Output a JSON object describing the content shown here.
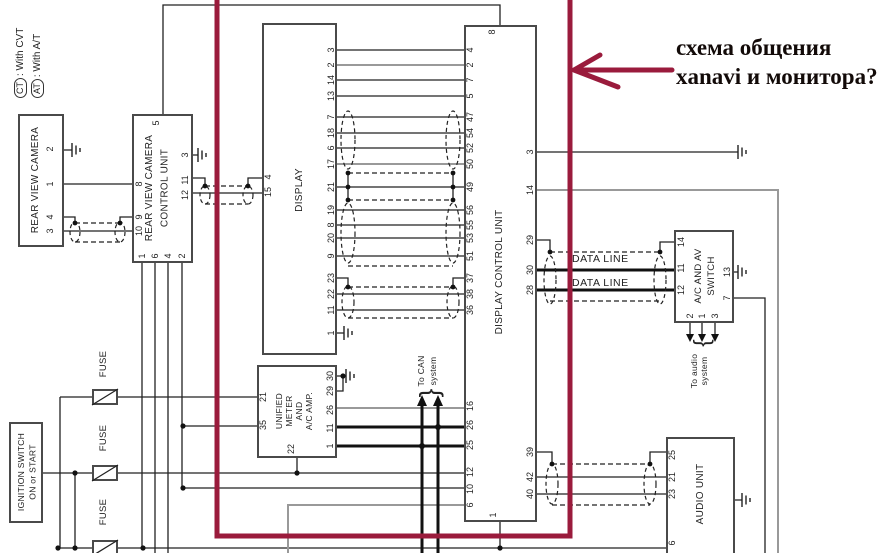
{
  "note": {
    "l1": "схема общения",
    "l2": "xanavi и монитора?"
  },
  "legend": {
    "ct_badge": "CT",
    "ct_text": ": With CVT",
    "at_badge": "AT",
    "at_text": ": With A/T"
  },
  "labels": {
    "data_line": "DATA LINE",
    "can1": "To CAN",
    "can2": "system",
    "aud1": "To audio",
    "aud2": "system",
    "fuse": "FUSE"
  },
  "cam": {
    "title": "REAR VIEW CAMERA",
    "p": [
      "2",
      "1",
      "4",
      "3"
    ]
  },
  "rvccu": {
    "t1": "REAR VIEW CAMERA",
    "t2": "CONTROL UNIT",
    "top": "5",
    "left": [
      "8",
      "9",
      "10"
    ],
    "right": [
      "3",
      "11",
      "12"
    ],
    "bottom": [
      "1",
      "6",
      "4",
      "2"
    ]
  },
  "disp": {
    "title": "DISPLAY",
    "left": [
      "4",
      "15"
    ],
    "right": [
      "3",
      "2",
      "14",
      "13",
      "7",
      "18",
      "6",
      "17",
      "21",
      "19",
      "8",
      "20",
      "9",
      "23",
      "22",
      "11",
      "1"
    ]
  },
  "dcu": {
    "title": "DISPLAY CONTROL UNIT",
    "top": "8",
    "bottom": "1",
    "lu": [
      "4",
      "2",
      "7",
      "5",
      "47",
      "54",
      "52",
      "50",
      "49",
      "56",
      "55",
      "53",
      "51",
      "37",
      "38",
      "36"
    ],
    "ll": [
      "16",
      "26",
      "25",
      "12",
      "10",
      "6"
    ],
    "right": [
      "3",
      "14",
      "29",
      "30",
      "28",
      "39",
      "42",
      "40"
    ]
  },
  "um": {
    "t": [
      "UNIFIED",
      "METER",
      "AND",
      "A/C AMP."
    ],
    "left": [
      "21",
      "35"
    ],
    "bottom": "22",
    "right": [
      "30",
      "29",
      "26",
      "11",
      "1"
    ]
  },
  "sw": {
    "t1": "A/C AND AV",
    "t2": "SWITCH",
    "left": [
      "14",
      "11",
      "12"
    ],
    "right": [
      "13",
      "7"
    ],
    "bottom": [
      "2",
      "1",
      "3"
    ]
  },
  "au": {
    "title": "AUDIO UNIT",
    "left": [
      "25",
      "21",
      "23",
      "6"
    ]
  },
  "ign": {
    "t1": "IGNITION SWITCH",
    "t2": "ON or START"
  },
  "colors": {
    "annotation": "#9a1b3c",
    "wire": "#222222",
    "gray_wire": "#999999",
    "thick_wire": "#111111"
  }
}
